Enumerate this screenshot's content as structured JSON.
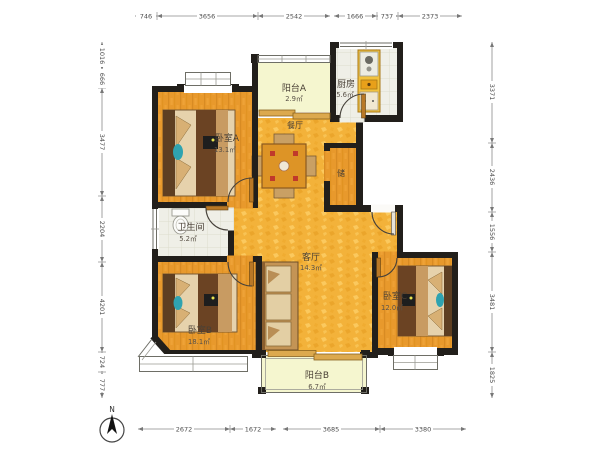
{
  "floorplan": {
    "compass": {
      "label": "N"
    },
    "rooms": {
      "bedroom_a": {
        "name": "卧室A",
        "area": "13.1㎡"
      },
      "balcony_a": {
        "name": "阳台A",
        "area": "2.9㎡"
      },
      "kitchen": {
        "name": "厨房",
        "area": "5.6㎡"
      },
      "dining": {
        "name": "餐厅"
      },
      "storage": {
        "name": "储"
      },
      "bathroom": {
        "name": "卫生间",
        "area": "5.2㎡"
      },
      "living": {
        "name": "客厅",
        "area": "14.3㎡"
      },
      "bedroom_b": {
        "name": "卧室B",
        "area": "18.1㎡"
      },
      "bedroom_c": {
        "name": "卧室C",
        "area": "12.0㎡"
      },
      "balcony_b": {
        "name": "阳台B",
        "area": "6.7㎡"
      }
    },
    "dimensions_mm": {
      "top": [
        "746",
        "3656",
        "2542",
        "1666",
        "737",
        "2373"
      ],
      "left": [
        "1016",
        "666",
        "3477",
        "2204",
        "4201",
        "724",
        "777"
      ],
      "right": [
        "3371",
        "2436",
        "1556",
        "3481",
        "1825"
      ],
      "bottom": [
        "2672",
        "1672",
        "3685",
        "3380"
      ]
    },
    "colors": {
      "wall": "#221F1B",
      "bedroom_floor": "#E8992C",
      "hall_floor": "#F3B23A",
      "tile_floor": "#EFEFE7",
      "balcony_floor": "#F5F6CF",
      "accent_teal": "#2FA3B0",
      "furniture_dark": "#6B4323"
    }
  }
}
